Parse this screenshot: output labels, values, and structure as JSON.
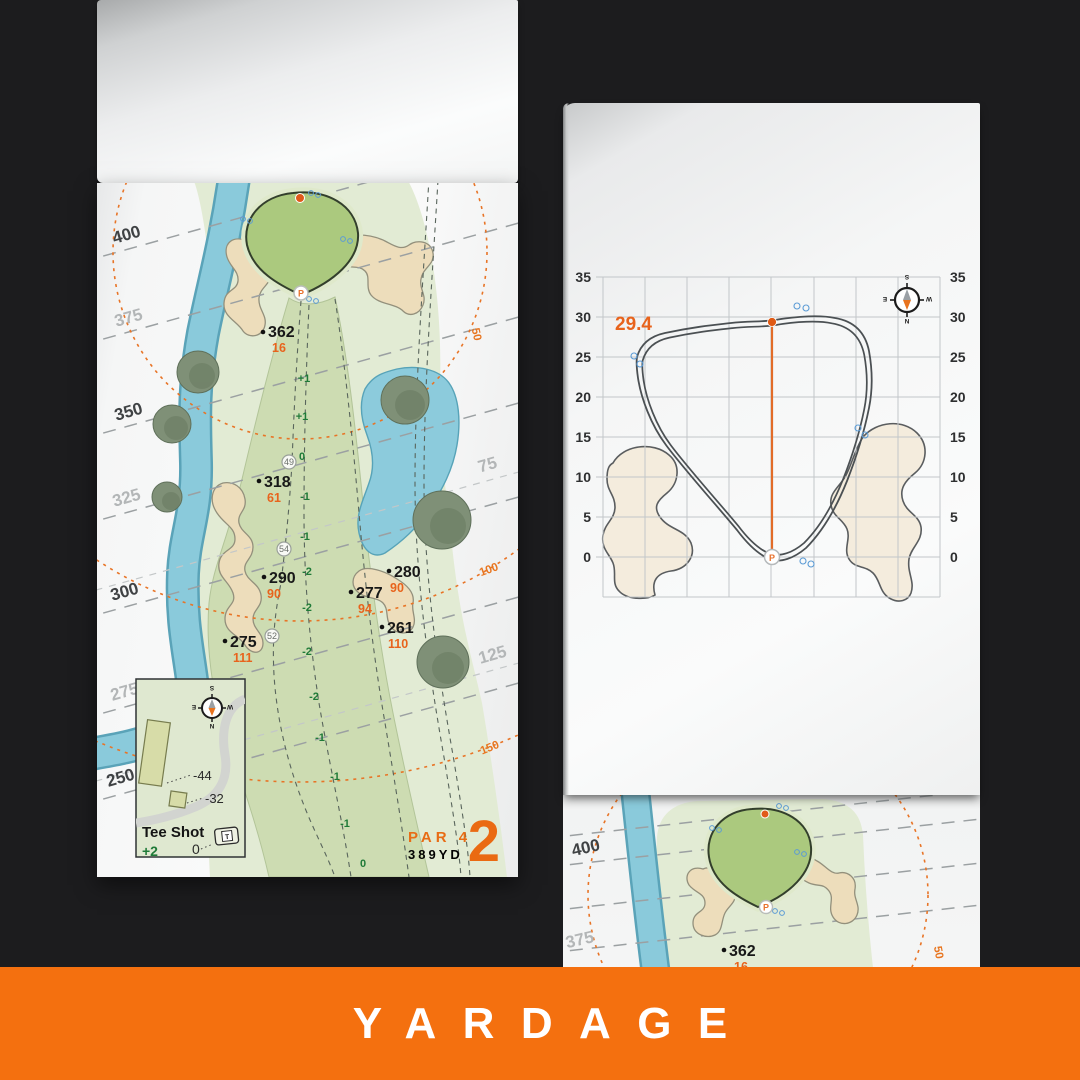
{
  "banner": {
    "label": "YARDAGE"
  },
  "colors": {
    "background": "#1c1c1e",
    "banner_orange": "#f4700f",
    "map_orange": "#e8631c",
    "slope_green": "#1f7a38",
    "water": "#85c8d9",
    "sand": "#edddbb",
    "fairway": "#cddcb2",
    "putting_green": "#abc97e"
  },
  "compass": {
    "n": "N",
    "e": "E",
    "s": "S",
    "w": "W"
  },
  "left_page": {
    "hole": {
      "number": "2",
      "par": "PAR 4",
      "yards": "389YD"
    },
    "contour_labels": [
      "400",
      "375",
      "350",
      "325",
      "300",
      "275",
      "250"
    ],
    "right_contour_labels": [
      "75",
      "125"
    ],
    "arc_labels": [
      "50",
      "100",
      "150"
    ],
    "points": [
      {
        "dist": "362",
        "carry": "16"
      },
      {
        "dist": "318",
        "carry": "61"
      },
      {
        "dist": "290",
        "carry": "90"
      },
      {
        "dist": "280",
        "carry": "90"
      },
      {
        "dist": "277",
        "carry": "94"
      },
      {
        "dist": "261",
        "carry": "110"
      },
      {
        "dist": "275",
        "carry": "111"
      }
    ],
    "slopes": [
      "+1",
      "+1",
      "0",
      "-1",
      "-1",
      "-2",
      "-2",
      "-2",
      "-2",
      "-1",
      "-1",
      "-1",
      "0"
    ],
    "checkpoints": [
      "49",
      "54",
      "52"
    ],
    "pin_letter": "P",
    "tee_inset": {
      "title": "Tee Shot",
      "shot_slope": "+2",
      "zero": "0",
      "long_tee": "-44",
      "short_tee": "-32",
      "tee_marker": "T"
    }
  },
  "right_page": {
    "pin_depth": "29.4",
    "axis_ticks": [
      "35",
      "30",
      "25",
      "20",
      "15",
      "10",
      "5",
      "0"
    ],
    "pin_letter": "P"
  },
  "third_page": {
    "contour_labels": [
      "400",
      "375"
    ],
    "arc_label": "50",
    "point": {
      "dist": "362",
      "carry": "16"
    },
    "pin_letter": "P"
  }
}
